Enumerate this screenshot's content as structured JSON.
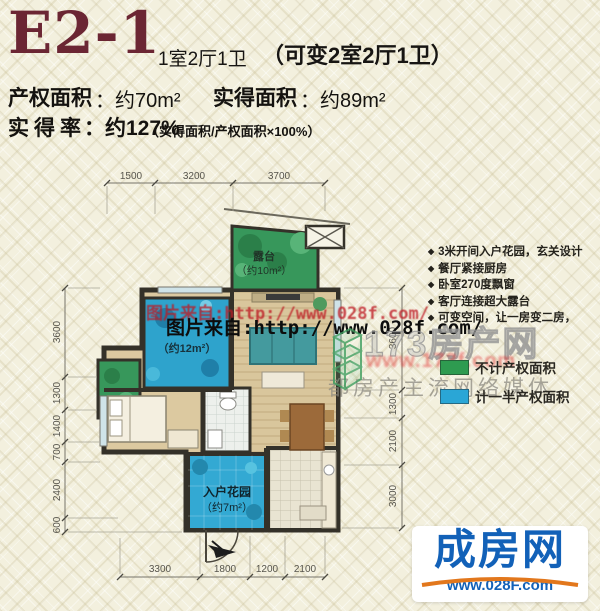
{
  "header": {
    "unit_code": "E2-1",
    "layout": "1室2厅1卫",
    "convertible": "（可变2室2厅1卫）",
    "property_area_label": "产权面积",
    "property_area_value": "：约70m²",
    "actual_area_label": "实得面积",
    "actual_area_value": "：约89m²",
    "ratio_label": "实得率",
    "ratio_value": "：约127%",
    "ratio_formula": "（实得面积/产权面积×100%）"
  },
  "features": {
    "bullet": "◆",
    "items": [
      "3米开间入户花园，玄关设计",
      "餐厅紧接厨房",
      "卧室270度飘窗",
      "客厅连接超大露台",
      "可变空间，让一房变二房，"
    ]
  },
  "legend": {
    "green_color": "#2e9b50",
    "blue_color": "#2aa6d6",
    "green_label": "不计产权面积",
    "blue_label": "计一半产权面积"
  },
  "plan": {
    "labels": {
      "balcony_name": "露台",
      "balcony_area": "（约10m²）",
      "room12_area": "（约12m²）",
      "garden_name": "入户花园",
      "garden_area": "（约7m²）"
    },
    "dims_top": [
      "1500",
      "3200",
      "3700"
    ],
    "dims_left": [
      "3600",
      "1300",
      "1400",
      "700",
      "2400",
      "600"
    ],
    "dims_right": [
      "3600",
      "1300",
      "2100",
      "3000"
    ],
    "dims_bottom": [
      "3300",
      "1800",
      "1200",
      "2100"
    ]
  },
  "watermarks": {
    "red_line": "图片来自:http://www.028f.com/",
    "black_line": "图片来自:http://www.028f.com/",
    "brand_big": "173房产网",
    "brand_url": "www.173f.com",
    "brand_slogan": "都房产主流网络媒体"
  },
  "footer_logo": {
    "name": "成房网",
    "url": "www.028F.com",
    "accent_blue": "#1261b8",
    "accent_orange": "#e2771c"
  }
}
